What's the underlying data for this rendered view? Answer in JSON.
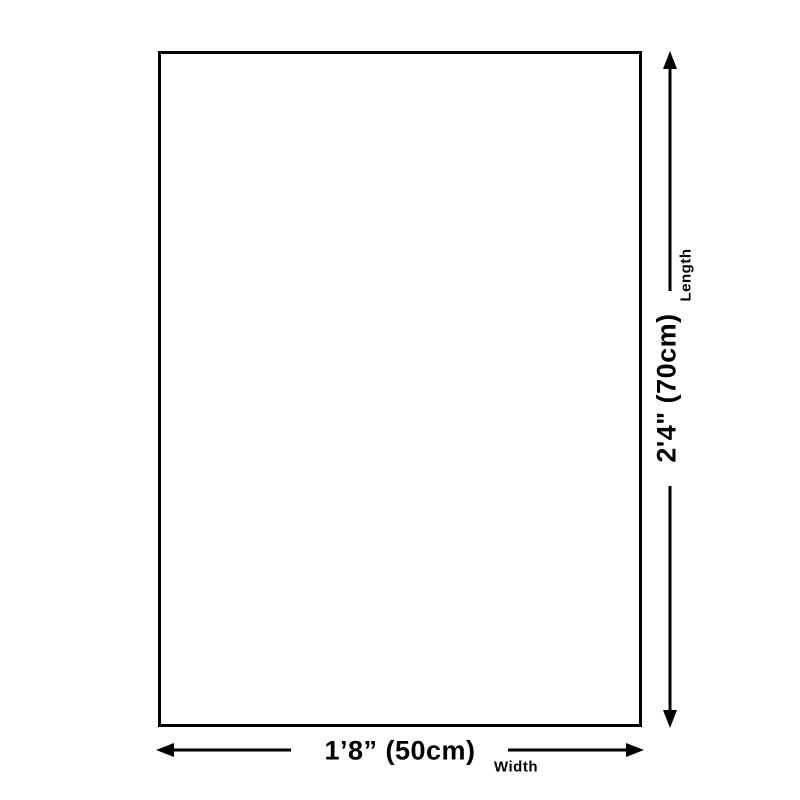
{
  "page": {
    "background_color": "#ffffff",
    "line_color": "#000000"
  },
  "diagram": {
    "type": "product-size-diagram",
    "shape": "rectangle",
    "width_dimension": {
      "value": "1’8” (50cm)",
      "label": "Width"
    },
    "length_dimension": {
      "value": "2'4\" (70cm)",
      "label": "Length"
    }
  }
}
